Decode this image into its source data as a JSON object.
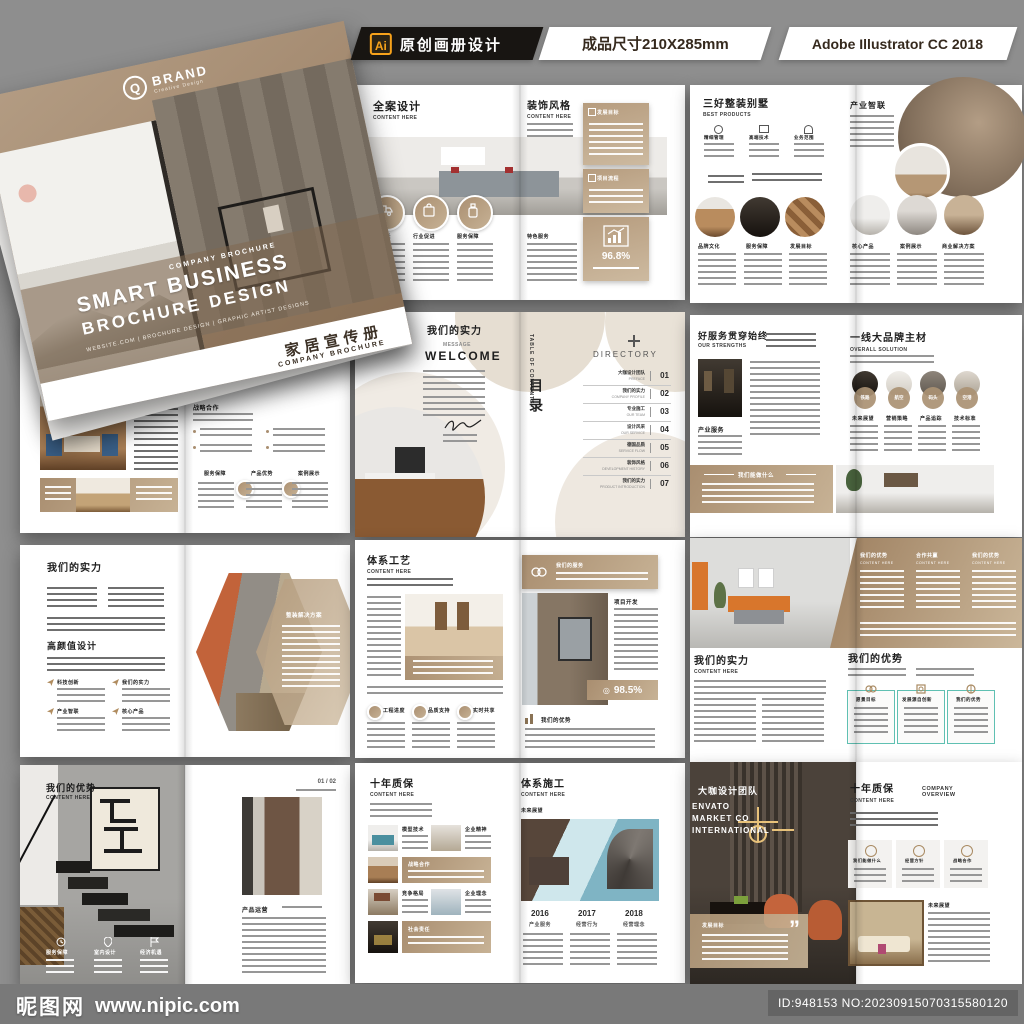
{
  "colors": {
    "gold": "#b59b7d",
    "ai_orange": "#f7a21b",
    "background": "#8e8e8e",
    "footer_bar": "#7a7a7a"
  },
  "icons": {
    "ai_badge": "Ai",
    "plus_icon": "+",
    "quote_mark": "”",
    "stat_target": "◎"
  },
  "header": {
    "product_title": "原创画册设计",
    "size_label": "成品尺寸210X285mm",
    "software_label": "Adobe Illustrator CC 2018"
  },
  "cover": {
    "logo_letter": "Q",
    "brand": "BRAND",
    "brand_tagline": "Creative Design",
    "kicker": "COMPANY BROCHURE",
    "title_line1": "SMART BUSINESS",
    "title_line2": "BROCHURE DESIGN",
    "strip": "WEBSITE.COM  |  BROCHURE DESIGN  |  GRAPHIC ARTIST DESIGNS",
    "cn_title": "家居宣传册",
    "cn_subtitle": "COMPANY BROCHURE"
  },
  "spreads": {
    "s1": {
      "left": {
        "title": "全案设计",
        "subtitle": "CONTENT HERE",
        "features": [
          "经济增长",
          "行业促进",
          "服务保障"
        ]
      },
      "right": {
        "title": "装饰风格",
        "subtitle": "CONTENT HERE",
        "box1": "发展目标",
        "box2": "项目流程",
        "stat": "96.8%",
        "bottom_label": "特色服务"
      }
    },
    "s2": {
      "left": {
        "title": "三好整装别墅",
        "subtitle": "BEST PRODUCTS",
        "mini": [
          "精细管理",
          "高端技术",
          "业务范围"
        ],
        "circles": [
          "品牌文化",
          "服务保障",
          "发展目标"
        ]
      },
      "right": {
        "title": "产业智联",
        "circles": [
          "核心产品",
          "案例展示",
          "商业解决方案"
        ]
      }
    },
    "s3": {
      "left": {
        "title": "环保用材",
        "subtitle": "COOPERATION AND WIN-WIN"
      },
      "right": {
        "heading": "战略合作",
        "columns": [
          "服务保障",
          "产品优势",
          "案例展示"
        ]
      }
    },
    "s4": {
      "left": {
        "title": "我们的实力",
        "deco": "MESSAGE",
        "welcome": "WELCOME"
      },
      "right": {
        "toc_en": "TABLE OF CONTENTS",
        "toc_cn": "目录",
        "directory_title": "DIRECTORY",
        "items": [
          {
            "cn": "大咖设计团队",
            "en": "PREFACE",
            "num": "01"
          },
          {
            "cn": "我们的实力",
            "en": "COMPANY PROFILE",
            "num": "02"
          },
          {
            "cn": "专业施工",
            "en": "OUR TEAM",
            "num": "03"
          },
          {
            "cn": "设计风采",
            "en": "OUR SERVICE",
            "num": "04"
          },
          {
            "cn": "德国品质",
            "en": "SERVICE FLOW",
            "num": "05"
          },
          {
            "cn": "装饰风格",
            "en": "DEVELOPMENT HISTORY",
            "num": "06"
          },
          {
            "cn": "我们的实力",
            "en": "PRODUCT INTRODUCTION",
            "num": "07"
          }
        ]
      }
    },
    "s5": {
      "left": {
        "title": "好服务贯穿始终",
        "subtitle": "OUR STRENGTHS",
        "subhead": "产业服务",
        "band": "我们能做什么"
      },
      "right": {
        "title": "一线大品牌主材",
        "subtitle": "OVERALL SOLUTION",
        "materials": [
          {
            "tag": "铁路",
            "label": "未来展望"
          },
          {
            "tag": "航空",
            "label": "营销策略"
          },
          {
            "tag": "码头",
            "label": "产品追踪"
          },
          {
            "tag": "空港",
            "label": "技术标准"
          }
        ]
      }
    },
    "s6": {
      "left": {
        "title": "我们的实力",
        "heading2": "高颜值设计",
        "items": [
          "科技创新",
          "我们的实力",
          "产业智联",
          "核心产品"
        ]
      },
      "right": {
        "hex_label": "整装解决方案"
      }
    },
    "s7": {
      "left": {
        "title": "体系工艺",
        "subtitle": "CONTENT HERE",
        "circles": [
          "工程进度",
          "品质支持",
          "实时共享"
        ]
      },
      "right": {
        "banner": "我们的服务",
        "side_heading": "项目开发",
        "stat": "98.5%",
        "bottom_heading": "我们的优势"
      }
    },
    "s8": {
      "top_cols": [
        {
          "cn": "我们的优势",
          "en": "CONTENT HERE"
        },
        {
          "cn": "合作共赢",
          "en": "CONTENT HERE"
        },
        {
          "cn": "我们的优势",
          "en": "CONTENT HERE"
        }
      ],
      "left": {
        "title": "我们的实力",
        "subtitle": "CONTENT HERE"
      },
      "right": {
        "title": "我们的优势",
        "boxes": [
          "愿景目标",
          "发展源自创新",
          "我们的优势"
        ]
      }
    },
    "s9": {
      "left": {
        "title": "我们的优势",
        "subtitle": "CONTENT HERE",
        "items": [
          "服务保障",
          "室内设计",
          "经济机遇"
        ]
      },
      "right": {
        "page_no": "01 / 02",
        "heading": "产品运营"
      }
    },
    "s10": {
      "left": {
        "title": "十年质保",
        "subtitle": "CONTENT HERE",
        "tag1": "模型技术",
        "tag2": "企业精神",
        "band1": "战略合作",
        "tag3": "竞争格局",
        "tag4": "企业理念",
        "band2": "社会责任"
      },
      "right": {
        "title": "体系施工",
        "subtitle": "CONTENT HERE",
        "subhead": "未来展望",
        "years": [
          {
            "year": "2016",
            "label": "产业服务"
          },
          {
            "year": "2017",
            "label": "经营行为"
          },
          {
            "year": "2018",
            "label": "经营理念"
          }
        ]
      }
    },
    "s11": {
      "left": {
        "title": "大咖设计团队",
        "l1": "ENVATO",
        "l2": "MARKET CO",
        "l3": "INTERNATIONAL",
        "band": "发展目标"
      },
      "right": {
        "title": "十年质保",
        "subtitle": "CONTENT HERE",
        "overview": "COMPANY OVERVIEW",
        "cards": [
          "我们能做什么",
          "经营方针",
          "战略合作"
        ],
        "subhead": "未来展望"
      }
    }
  },
  "footer": {
    "site_name": "昵图网",
    "site_url": "www.nipic.com",
    "image_id": "ID:948153 NO:20230915070315580120"
  }
}
